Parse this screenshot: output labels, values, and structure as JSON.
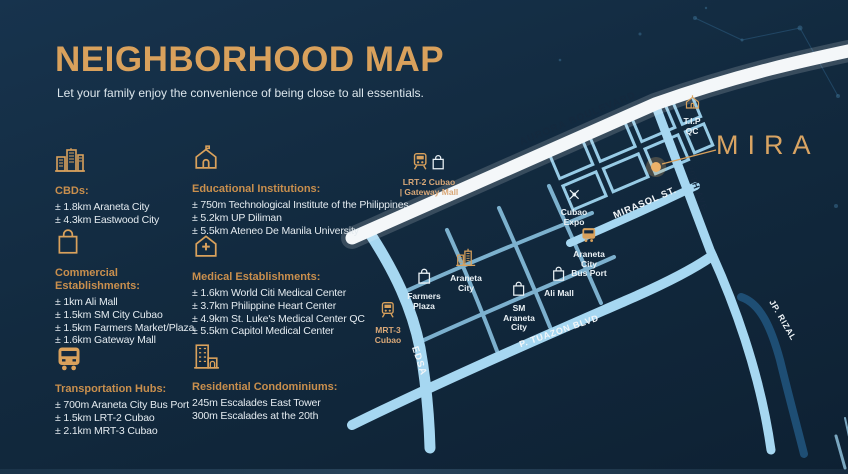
{
  "page": {
    "title": "NEIGHBORHOOD MAP",
    "subtitle": "Let your family enjoy the convenience of being close to all essentials."
  },
  "colors": {
    "background": "#122A3F",
    "gold": "#D9A15C",
    "text": "#E4EBF0",
    "road_white": "#F4F7F9",
    "road_light": "#A6D7F1",
    "road_dark": "#1E4E74",
    "site_marker": "#ECB269"
  },
  "legend": {
    "categories": [
      {
        "id": "cbds",
        "icon": "city-buildings-icon",
        "title": "CBDs:",
        "items": [
          "± 1.8km Araneta City",
          "± 4.3km Eastwood City"
        ]
      },
      {
        "id": "educational",
        "icon": "school-icon",
        "title": "Educational Institutions:",
        "items": [
          "± 750m Technological Institute of the Philippines",
          "± 5.2km UP Diliman",
          "± 5.5km Ateneo De Manila University"
        ]
      },
      {
        "id": "commercial",
        "icon": "shopping-bag-icon",
        "title": "Commercial\nEstablishments:",
        "items": [
          "± 1km Ali Mall",
          "± 1.5km SM City Cubao",
          "± 1.5km Farmers Market/Plaza",
          "± 1.6km Gateway Mall"
        ]
      },
      {
        "id": "medical",
        "icon": "medical-cross-icon",
        "title": "Medical Establishments:",
        "items": [
          "± 1.6km World Citi Medical Center",
          "± 3.7km Philippine Heart Center",
          "± 4.9km St. Luke's Medical Center QC",
          "± 5.5km Capitol Medical Center"
        ]
      },
      {
        "id": "transportation",
        "icon": "bus-icon",
        "title": "Transportation Hubs:",
        "items": [
          "± 700m Araneta City Bus Port",
          "± 1.5km LRT-2 Cubao",
          "± 2.1km MRT-3 Cubao"
        ]
      },
      {
        "id": "residential",
        "icon": "condominium-icon",
        "title": "Residential Condominiums:",
        "items": [
          "245m Escalades East Tower",
          "300m Escalades at the 20th"
        ]
      }
    ]
  },
  "map": {
    "brand": {
      "logo": "MIRA"
    },
    "streets": {
      "aurora": {
        "label": "AURORA BOULEVARD"
      },
      "mirasol": {
        "label": "MIRASOL ST."
      },
      "p_tuazon": {
        "label": "P. TUAZON BLVD"
      },
      "edsa": {
        "label": "EDSA"
      },
      "ave20th": {
        "label": "20TH AVE"
      },
      "jp_rizal": {
        "label": "JP. RIZAL"
      }
    },
    "pois": {
      "lrt2": {
        "label": "LRT-2 Cubao\n| Gateway Mall"
      },
      "tip": {
        "label": "T.I.P\nQC"
      },
      "cubao_expo": {
        "label": "Cubao\nExpo"
      },
      "bus_port": {
        "label": "Araneta\nCity\nBus Port"
      },
      "ali_mall": {
        "label": "Ali Mall"
      },
      "farmers_plaza": {
        "label": "Farmers\nPlaza"
      },
      "araneta_city": {
        "label": "Araneta\nCity"
      },
      "sm_araneta": {
        "label": "SM\nAraneta\nCity"
      },
      "mrt3": {
        "label": "MRT-3\nCubao"
      }
    }
  }
}
